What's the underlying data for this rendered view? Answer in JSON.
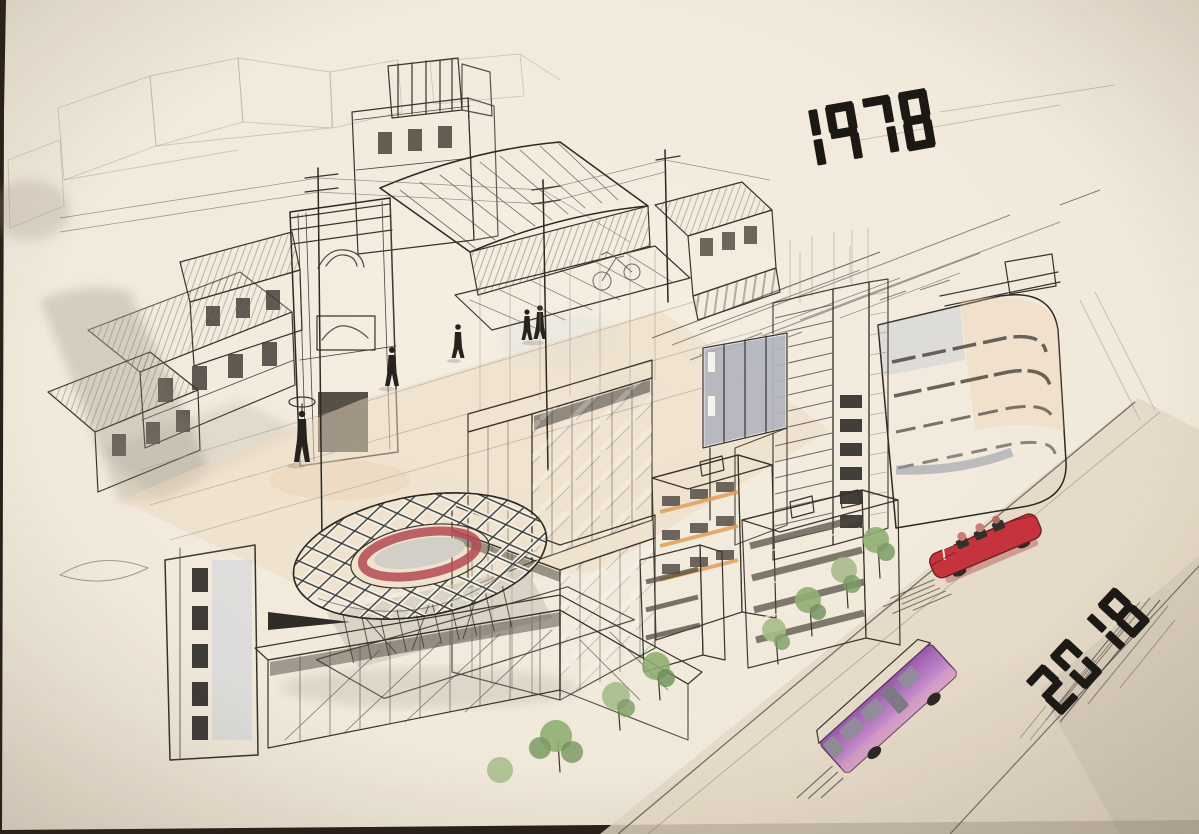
{
  "artwork": {
    "medium": "ink-and-watercolor-sketch-photo"
  },
  "labels": {
    "year_old": "1978",
    "year_new": "2018"
  },
  "palette": {
    "table_dark": "#2a211a",
    "paper": "#f2ebdd",
    "ink": "#1c1915",
    "sepia_roof": "#d8cbb0",
    "shadow_wash": "#8b8374",
    "street_wash": "#ecd9bf",
    "glass_blue": "#aab3c9",
    "band_cream": "#f0e9c4",
    "louver_green": "#e2e8dc",
    "accent_yellow_green": "#dde696",
    "apartment_yellow": "#e8bf62",
    "apartment_orange": "#dfa066",
    "tree_green": "#8fae72",
    "stadium_red": "#b34a52",
    "car_red": "#c5343c",
    "bus_purple": "#b06cc0"
  }
}
